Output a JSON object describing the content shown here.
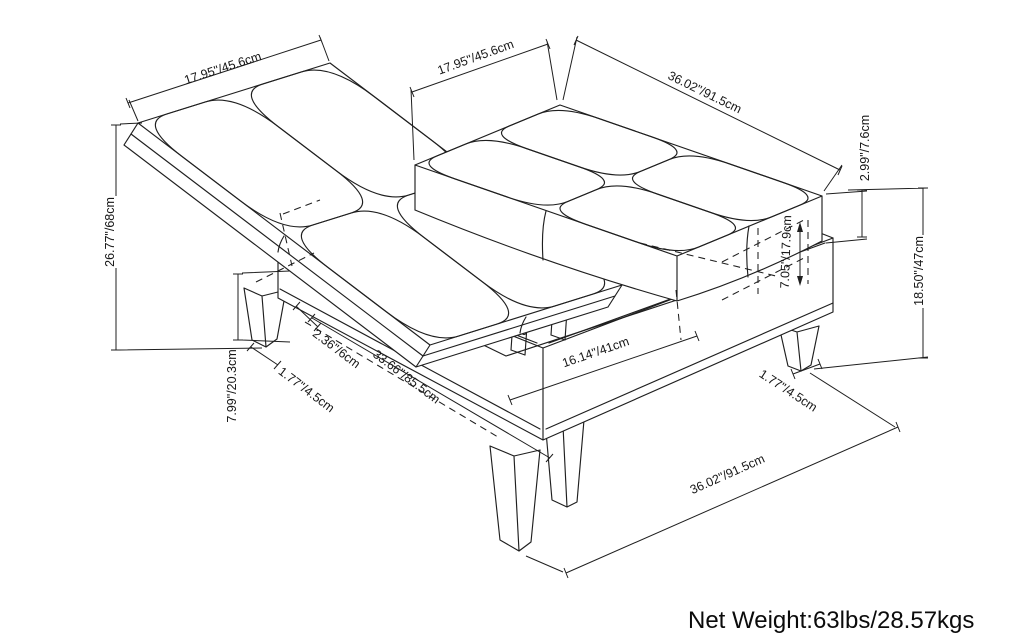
{
  "figure": {
    "type": "technical-line-drawing",
    "subject": "Storage ottoman coffee table with tufted flip-open lid shown in open position, annotated with dimensions",
    "line_color": "#1f1f1f",
    "background_color": "#ffffff"
  },
  "dimensions": {
    "lid_panel_width": "17.95\"/45.6cm",
    "fixed_panel_width": "17.95\"/45.6cm",
    "overall_depth": "36.02\"/91.5cm",
    "cushion_thickness": "2.99\"/7.6cm",
    "overall_height": "18.50\"/47cm",
    "open_lid_height": "26.77\"/68cm",
    "base_clearance": "7.99\"/20.3cm",
    "hinge_offset": "2.36\"/6cm",
    "front_leg_width": "1.77\"/4.5cm",
    "open_lid_reach": "33.66\"/85.5cm",
    "storage_interior_width": "16.14\"/41cm",
    "storage_interior_depth": "7.05\"/17.9cm",
    "rear_leg_width": "1.77\"/4.5cm",
    "overall_width": "36.02\"/91.5cm"
  },
  "footer": {
    "net_weight": "Net Weight:63lbs/28.57kgs"
  }
}
